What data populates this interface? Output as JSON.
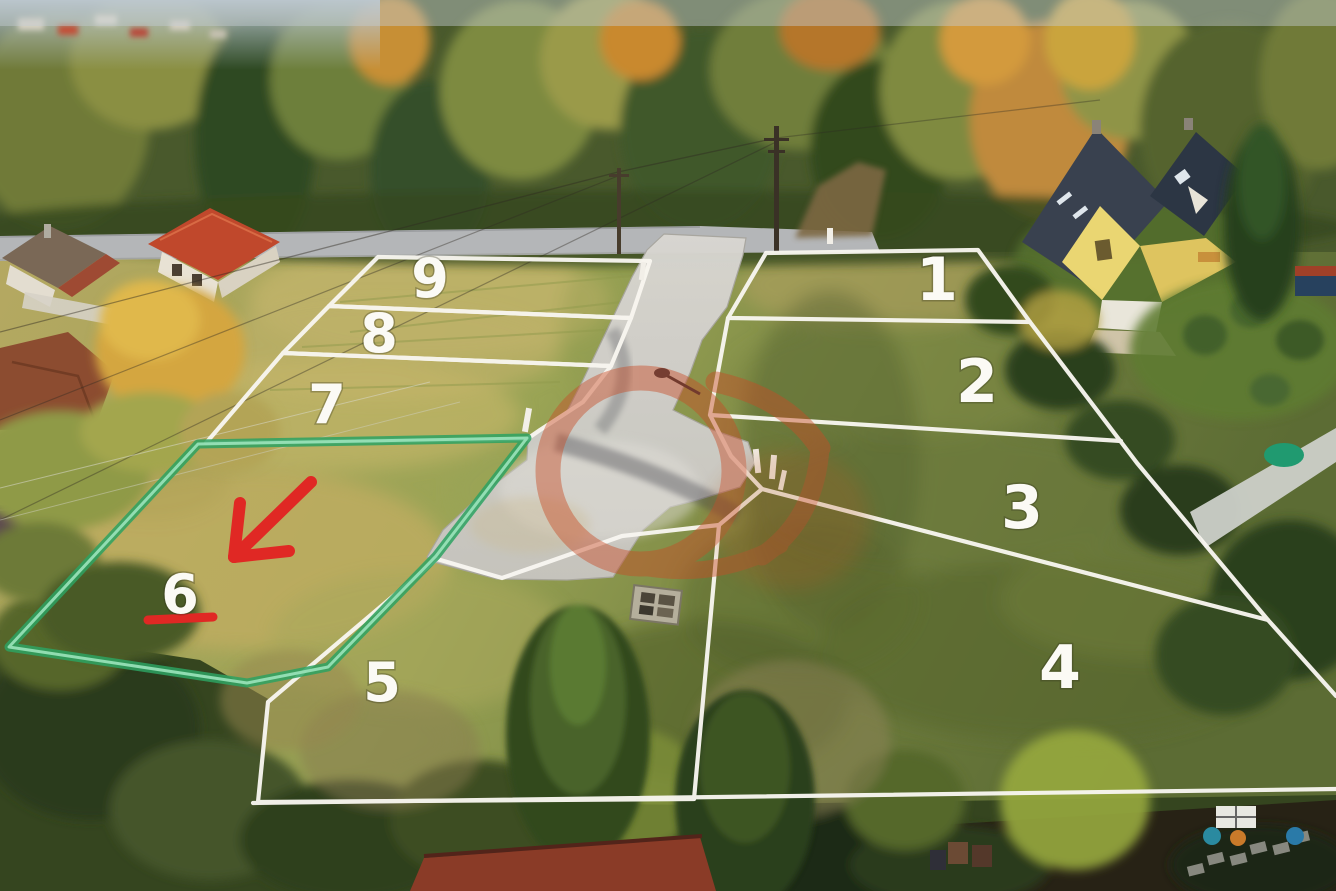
{
  "scene": {
    "type": "aerial drone photograph",
    "description": "Autumn aerial view of nine numbered building plots beside a forest road with a new paved turning area; plot 6 is outlined in green and marked with a red arrow.",
    "season": "autumn"
  },
  "plots": {
    "count": 9,
    "items": [
      {
        "number": "1"
      },
      {
        "number": "2"
      },
      {
        "number": "3"
      },
      {
        "number": "4"
      },
      {
        "number": "5"
      },
      {
        "number": "6",
        "highlighted": true
      },
      {
        "number": "7"
      },
      {
        "number": "8"
      },
      {
        "number": "9"
      }
    ]
  },
  "highlight": {
    "plot": "6",
    "outline_color": "#2da262",
    "arrow_color": "#e02824",
    "underline_color": "#e02824"
  },
  "markings": {
    "boundary_line_color": "#f8f6f0",
    "number_color": "#ffffff"
  },
  "watermark": {
    "style": "semi-transparent agency logo",
    "color": "#c84d27"
  }
}
